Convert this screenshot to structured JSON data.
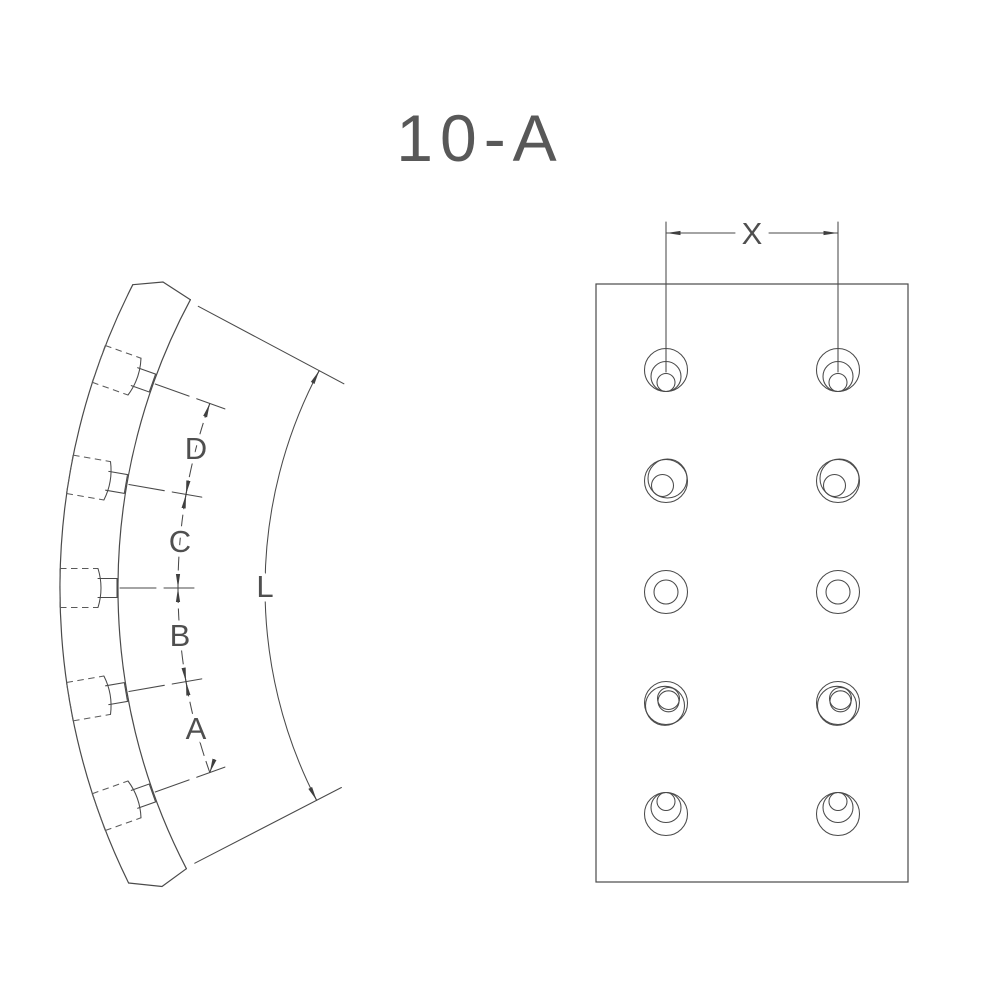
{
  "drawing": {
    "title": "10-A",
    "colors": {
      "line": "#4a4a4a",
      "hidden_line": "#5a5a5a",
      "text": "#4f4f4f",
      "background": "#ffffff"
    }
  },
  "side_view": {
    "labels": {
      "pitch_top": "D",
      "pitch_upper": "C",
      "pitch_lower": "B",
      "pitch_bottom": "A",
      "arc_length": "L"
    }
  },
  "plan_view": {
    "labels": {
      "hole_spacing": "X"
    }
  }
}
